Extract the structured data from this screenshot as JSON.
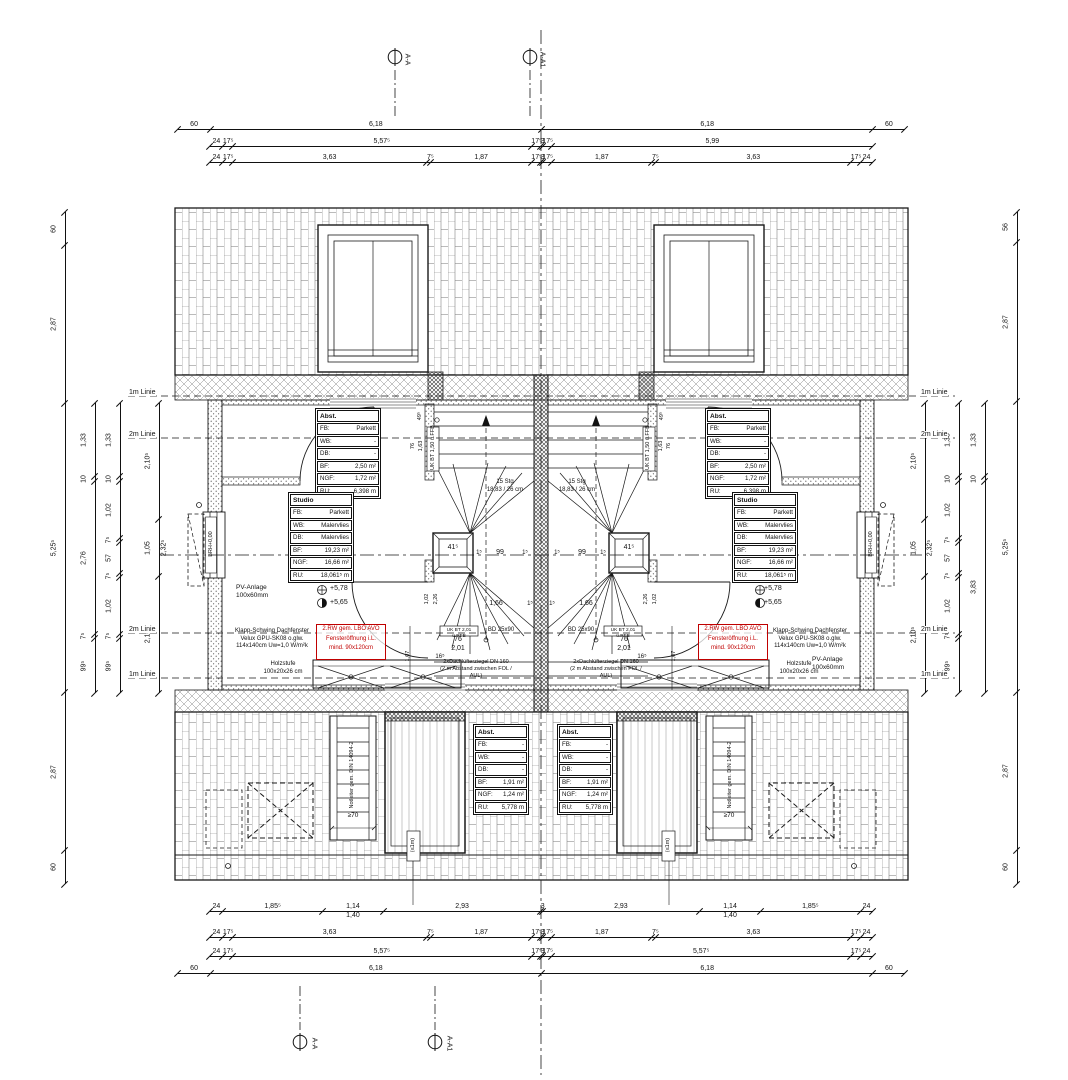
{
  "markers": {
    "aa": "A-A",
    "aa1": "A-A1"
  },
  "side": {
    "one": "1m Linie",
    "two": "2m Linie"
  },
  "tables": {
    "abst_top": {
      "title": "Abst.",
      "rows": [
        [
          "FB:",
          "Parkett"
        ],
        [
          "WB:",
          "-"
        ],
        [
          "DB:",
          "-"
        ],
        [
          "BF:",
          "2,50 m²"
        ],
        [
          "NGF:",
          "1,72 m²"
        ],
        [
          "RU:",
          "6,398 m"
        ]
      ]
    },
    "studio": {
      "title": "Studio",
      "rows": [
        [
          "FB:",
          "Parkett"
        ],
        [
          "WB:",
          "Malervlies"
        ],
        [
          "DB:",
          "Malervlies"
        ],
        [
          "BF:",
          "19,23 m²"
        ],
        [
          "NGF:",
          "16,66 m²"
        ],
        [
          "RU:",
          "18,061⁵ m"
        ]
      ]
    },
    "abst_bottom": {
      "title": "Abst.",
      "rows": [
        [
          "FB:",
          "-"
        ],
        [
          "WB:",
          "-"
        ],
        [
          "DB:",
          "-"
        ],
        [
          "BF:",
          "1,91 m²"
        ],
        [
          "NGF:",
          "1,24 m²"
        ],
        [
          "RU:",
          "5,778 m"
        ]
      ]
    }
  },
  "annotations": {
    "stairs": [
      "15 Stg",
      "18,83 / 26 cm"
    ],
    "window_note": [
      "Klapp-Schwing Dachfenster",
      "Velux GPU-SK08 o.glw.",
      "114x140cm Uw=1,0 W/m²k"
    ],
    "red_note": [
      "2.RW gem. LBO AVO",
      "Fensteröffnung i.L.",
      "mind. 90x120cm"
    ],
    "holzstufe": [
      "Holzstufe",
      "100x20x26 cm"
    ],
    "pv": [
      "PV-Anlage",
      "100x60mm"
    ],
    "luefter": [
      "2xDachlüfterziegel DN 160",
      "(2 m Abstand zwischen FOL / AUL)"
    ],
    "notleiter": "Notleiter gem. DIN 14094-2",
    "levels": {
      "upper": "+5,78",
      "lower": "+5,65"
    }
  },
  "plan": {
    "d415": "41⁵",
    "d99": "99",
    "d15": "1⁵",
    "d166": "1,66",
    "d76": "76",
    "d201": "2,01",
    "d165": "16⁵",
    "d107": "1,07",
    "d495": "49⁵",
    "d163": "1,63",
    "d102": "1,02",
    "d226": "2,26",
    "ukbt150": "UK BT 1,50 ü.FFB",
    "ukbt201": "UK BT 2,01 ü.RFB",
    "bd": "BD 25x90",
    "brh": "BRH+0,00",
    "ge70": "≥70",
    "le1m": "(≤1m)"
  },
  "dims": {
    "top": [
      {
        "segs": [
          {
            "t": "60",
            "v": 0.6
          },
          {
            "t": "6,18",
            "v": 6.18
          },
          {
            "t": "6,18",
            "v": 6.18
          },
          {
            "t": "60",
            "v": 0.6
          }
        ]
      },
      {
        "segs": [
          {
            "t": "24",
            "v": 0.24
          },
          {
            "t": "17⁵",
            "v": 0.175
          },
          {
            "t": "5,57⁵",
            "v": 5.575
          },
          {
            "t": "17⁵",
            "v": 0.175
          },
          {
            "t": "3",
            "v": 0.03
          },
          {
            "t": "17⁵",
            "v": 0.175
          },
          {
            "t": "5,99",
            "v": 5.99
          }
        ]
      },
      {
        "segs": [
          {
            "t": "24",
            "v": 0.24
          },
          {
            "t": "17⁵",
            "v": 0.175
          },
          {
            "t": "3,63",
            "v": 3.63
          },
          {
            "t": "7⁵",
            "v": 0.075
          },
          {
            "t": "1,87",
            "v": 1.87
          },
          {
            "t": "17⁵",
            "v": 0.175
          },
          {
            "t": "3",
            "v": 0.03
          },
          {
            "t": "17⁵",
            "v": 0.175
          },
          {
            "t": "1,87",
            "v": 1.87
          },
          {
            "t": "7⁵",
            "v": 0.075
          },
          {
            "t": "3,63",
            "v": 3.63
          },
          {
            "t": "17⁵",
            "v": 0.175
          },
          {
            "t": "24",
            "v": 0.24
          }
        ]
      }
    ],
    "bottom": [
      {
        "segs": [
          {
            "t": "24",
            "v": 0.24
          },
          {
            "t": "1,85⁵",
            "v": 1.855
          },
          {
            "t": "1,14",
            "t2": "1,40",
            "v": 1.14
          },
          {
            "t": "2,93",
            "v": 2.93
          },
          {
            "t": "3",
            "v": 0.03
          },
          {
            "t": "2,93",
            "v": 2.93
          },
          {
            "t": "1,14",
            "t2": "1,40",
            "v": 1.14
          },
          {
            "t": "1,85⁵",
            "v": 1.855
          },
          {
            "t": "24",
            "v": 0.24
          }
        ]
      },
      {
        "segs": [
          {
            "t": "24",
            "v": 0.24
          },
          {
            "t": "17⁵",
            "v": 0.175
          },
          {
            "t": "3,63",
            "v": 3.63
          },
          {
            "t": "7⁵",
            "v": 0.075
          },
          {
            "t": "1,87",
            "v": 1.87
          },
          {
            "t": "17⁵",
            "v": 0.175
          },
          {
            "t": "3",
            "v": 0.03
          },
          {
            "t": "17⁵",
            "v": 0.175
          },
          {
            "t": "1,87",
            "v": 1.87
          },
          {
            "t": "7⁵",
            "v": 0.075
          },
          {
            "t": "3,63",
            "v": 3.63
          },
          {
            "t": "17⁵",
            "v": 0.175
          },
          {
            "t": "24",
            "v": 0.24
          }
        ]
      },
      {
        "segs": [
          {
            "t": "24",
            "v": 0.24
          },
          {
            "t": "17⁵",
            "v": 0.175
          },
          {
            "t": "5,57⁵",
            "v": 5.575
          },
          {
            "t": "17⁵",
            "v": 0.175
          },
          {
            "t": "3",
            "v": 0.03
          },
          {
            "t": "17⁵",
            "v": 0.175
          },
          {
            "t": "5,57⁵",
            "v": 5.575
          },
          {
            "t": "17⁵",
            "v": 0.175
          },
          {
            "t": "24",
            "v": 0.24
          }
        ]
      },
      {
        "segs": [
          {
            "t": "60",
            "v": 0.6
          },
          {
            "t": "6,18",
            "v": 6.18
          },
          {
            "t": "6,18",
            "v": 6.18
          },
          {
            "t": "60",
            "v": 0.6
          }
        ]
      }
    ],
    "left": [
      {
        "segs": [
          {
            "t": "60",
            "v": 0.6
          },
          {
            "t": "2,87",
            "v": 2.87
          },
          {
            "t": "5,25⁵",
            "v": 5.255
          },
          {
            "t": "2,87",
            "v": 2.87
          },
          {
            "t": "60",
            "v": 0.6
          }
        ]
      },
      {
        "segs": [
          {
            "t": "1,33",
            "v": 1.33
          },
          {
            "t": "10",
            "v": 0.1
          },
          {
            "t": "2,76",
            "v": 2.76
          },
          {
            "t": "7⁵",
            "v": 0.075
          },
          {
            "t": "99⁵",
            "v": 0.995
          }
        ]
      },
      {
        "segs": [
          {
            "t": "1,33",
            "v": 1.33
          },
          {
            "t": "10",
            "v": 0.1
          },
          {
            "t": "1,02",
            "v": 1.02
          },
          {
            "t": "7⁵",
            "v": 0.075
          },
          {
            "t": "57",
            "v": 0.57
          },
          {
            "t": "7⁵",
            "v": 0.075
          },
          {
            "t": "1,02",
            "v": 1.02
          },
          {
            "t": "7⁵",
            "v": 0.075
          },
          {
            "t": "99⁵",
            "v": 0.995
          }
        ]
      },
      {
        "segs": [
          {
            "t": "2,10⁵",
            "v": 2.105
          },
          {
            "t": "1,05",
            "t2": "2,32⁵",
            "v": 1.05
          },
          {
            "t": "2,10⁵",
            "v": 2.105
          }
        ]
      }
    ],
    "right": [
      {
        "segs": [
          {
            "t": "2,10⁵",
            "v": 2.105
          },
          {
            "t": "1,05",
            "t2": "2,32⁵",
            "v": 1.05
          },
          {
            "t": "2,10⁵",
            "v": 2.105
          }
        ]
      },
      {
        "segs": [
          {
            "t": "1,33",
            "v": 1.33
          },
          {
            "t": "10",
            "v": 0.1
          },
          {
            "t": "1,02",
            "v": 1.02
          },
          {
            "t": "7⁵",
            "v": 0.075
          },
          {
            "t": "57",
            "v": 0.57
          },
          {
            "t": "7⁵",
            "v": 0.075
          },
          {
            "t": "1,02",
            "v": 1.02
          },
          {
            "t": "7⁵",
            "v": 0.075
          },
          {
            "t": "99⁵",
            "v": 0.995
          }
        ]
      },
      {
        "segs": [
          {
            "t": "1,33",
            "v": 1.33
          },
          {
            "t": "10",
            "v": 0.1
          },
          {
            "t": "3,83",
            "v": 3.83
          }
        ]
      },
      {
        "segs": [
          {
            "t": "56",
            "v": 0.56
          },
          {
            "t": "2,87",
            "v": 2.87
          },
          {
            "t": "5,25⁵",
            "v": 5.255
          },
          {
            "t": "2,87",
            "v": 2.87
          },
          {
            "t": "60",
            "v": 0.6
          }
        ]
      }
    ]
  }
}
